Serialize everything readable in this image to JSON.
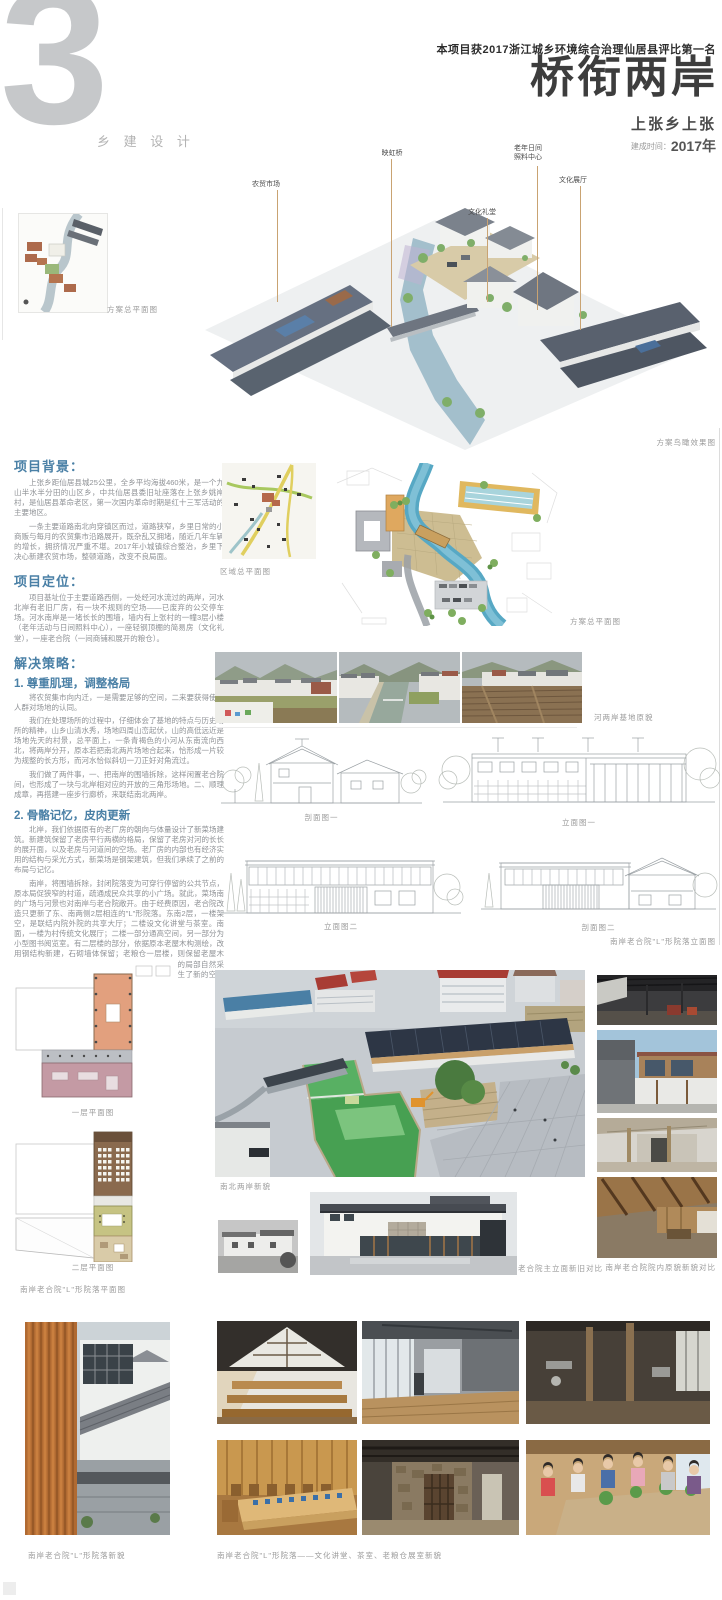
{
  "header": {
    "number": "3",
    "category": "乡 建 设 计",
    "award": "本项目获2017浙江城乡环境综合治理仙居县评比第一名",
    "title": "桥衔两岸",
    "subtitle": "上张乡上张",
    "date_label": "建成时间：",
    "date_value": "2017年"
  },
  "axon": {
    "caption": "方案鸟瞰效果图",
    "labels": {
      "market": "农贸市场",
      "bridge": "映虹桥",
      "hall": "文化礼堂",
      "care_line1": "老年日间",
      "care_line2": "照料中心",
      "exhibition": "文化展厅"
    }
  },
  "plans": {
    "thumb_caption": "方案总平面图",
    "region_caption": "区域总平面图",
    "master_caption": "方案总平面图"
  },
  "sections": {
    "background": {
      "heading": "项目背景：",
      "p1": "上张乡距仙居县城25公里，全乡平均海拔460米，是一个九山半水半分田的山区乡，中共仙居县委旧址座落在上张乡姚岸村，是仙居县革命老区，第一次国内革命时期是红十三军活动的主要地区。",
      "p2": "一条主要道路南北向穿镇区而过，道路狭窄，乡里日常的小商贩与每月的农贸集市沿路展开，既杂乱又拥堵，随近几年车辆的增长，拥挤情况严重不堪。2017年小城镇综合整治，乡里下决心新建农贸市场，整顿道路，改变不良局面。"
    },
    "positioning": {
      "heading": "项目定位：",
      "p1": "项目基址位于主要道路西侧，一处经河水流过的两岸，河水北岸有老旧厂房，有一块不规则的空场——已废弃的公交停车场。河水南岸是一堵长长的围墙，墙内有上张村的一幢3层小楼（老年活动与日间照料中心），一座轻钢顶棚的简易房（文化礼堂），一座老合院（一间商铺和展开的粮仓）。"
    },
    "strategy": {
      "heading": "解决策略：",
      "s1": {
        "title": "1. 尊重肌理，调整格局",
        "p1": "将农贸集市向内迁，一是需要足够的空间，二来要获得使用人群对场地的认同。",
        "p2": "我们在处理场所的过程中，仔细体会了基地的特点与历史场所的精神，山乡山清水秀，场地四周山峦起伏，山的高低远近是场地先天的村景，总平面上，一条青褐色的小河从东南流向西北，将两岸分开，原本若把南北两片场地合起来，恰形成一片较为规整的长方形，而河水恰似斜切一刀正好对角流过。",
        "p3": "我们做了两件事，一、把南岸的围墙拆除，这样闲置老合院间，也形成了一块与北岸相对应的开放的三角形场地。二、顺理成章，再搭建一座步行廊桥，来联结南北两岸。"
      },
      "s2": {
        "title": "2. 骨骼记忆，皮肉更新",
        "p1": "北岸，我们依据原有的老厂房的朝向与体量设计了新菜场建筑。新建筑保留了老房平行两横的格局，保留了老房对河的长长的展开面，以及老房与河道间的空场。老厂房的内部也有经济实用的结构与采光方式，新菜场是钢架建筑，但我们承续了之前的布局与记忆。",
        "p2": "南岸，将围墙拆除，封闭院落变为可穿行停留的公共节点，原本局促狭窄的村道，疏通成民众共享的小广场。就此，菜场南的广场与河景也对南岸与老合院敞开。由于经费原因，老合院改造只更新了东、南两侧2层相连的\"L\"形院落。东南2层，一楼架空，是联结内院外院的共享大厅；二楼设文化讲堂与茶室。南面，一楼为村传统文化展厅；二楼一部分通高空间，另一部分为小型图书阅览室。有二层楼的部分，依据原本老屋木构测绘，改用钢结构新建，石砌墙体保留；老粮仓一层楼，则保留老屋木构，包括墙面、地面高差等，增加了屋顶与墙面的局部自然采光，为珍视老空间的营造智慧与记忆，同时也产生了新的空间感、新老材料的对比。"
      }
    }
  },
  "figures": {
    "old_site": "河两岸基地原貌",
    "section1": "剖面图一",
    "elevation1": "立面图一",
    "elevation2": "立面图二",
    "section2": "剖面图二",
    "elevation_group": "南岸老合院\"L\"形院落立面图",
    "floor1": "一层平面图",
    "floor2": "二层平面图",
    "plan_group": "南岸老合院\"L\"形院落平面图",
    "aerial": "南北两岸新貌",
    "facade_compare": "老合院主立面新旧对比",
    "courtyard_compare": "南岸老合院院内原貌新貌对比",
    "courtyard_new": "南岸老合院\"L\"形院落新貌",
    "interior": "南岸老合院\"L\"形院落——文化讲堂、茶室、老粮仓展室新貌"
  },
  "colors": {
    "accent_blue": "#4a80a6",
    "leader_tan": "#c9a372",
    "number_gray": "#c6c8ca",
    "river_blue": "#57a8c4",
    "water_green": "#47a052"
  }
}
